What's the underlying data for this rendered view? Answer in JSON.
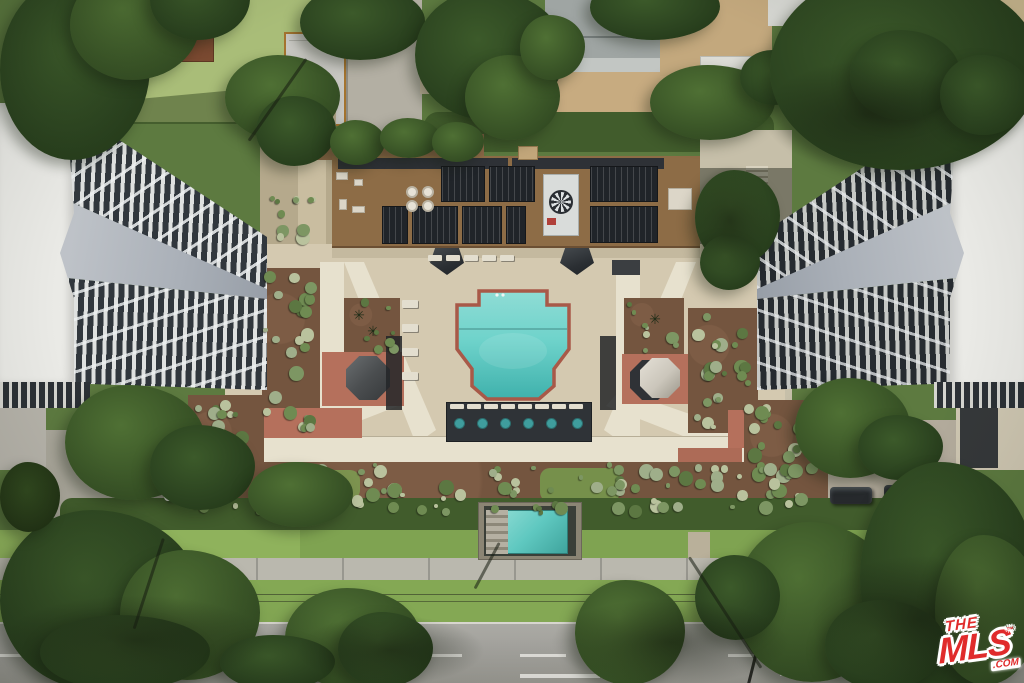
{
  "watermark": {
    "the": "THE",
    "mls": "MLS",
    "tm": "™",
    "com": ".COM"
  },
  "palette": {
    "base": "#5d7a40",
    "pool": "#6fd3cb",
    "pool_deep": "#3fb1ac",
    "pool_border": "#a85948",
    "deck": "#d4c9b0",
    "walk": "#e7e1ce",
    "roof": "#8d6c46",
    "panel": "#202429",
    "white_roof": "#ebebe7",
    "ramp": "#aab0b8",
    "bal_light": "#dfe1e0",
    "bal_dark": "#31373d",
    "balr_light": "#c6c8c5",
    "balr_dark": "#262b30",
    "mulch": "#74553f",
    "mulch2": "#6e513c",
    "red_pavers": "#b5705c",
    "red_curb": "#b43d30",
    "lawn": "#84a854",
    "lawn2": "#7fa351",
    "lawn_top": "#a9bd78",
    "hedge": "#415c2c",
    "street": "#a2a19c",
    "sidewalk": "#bab8ae",
    "sand": "#c7ab80",
    "garage": "#c9c8c3",
    "trim": "#a5742f",
    "spa": "#5fc8c0",
    "logo_red": "#e02b2b",
    "drive": "#aaa79b",
    "charcoal": "#2f3337",
    "octa_dark": "#4b4e50",
    "octa_light": "#cbc6bb"
  },
  "scene": {
    "kind": "aerial-photo",
    "elements": [
      "neighborhood-top",
      "left-tower",
      "right-tower",
      "central-rooftop-solar",
      "cross-shaped-pool",
      "pool-deck",
      "garden-beds",
      "red-paver-plazas",
      "umbrella-octagons",
      "pergola-with-spa-tables",
      "sunken-spa-court",
      "hedge-row",
      "sidewalk",
      "street",
      "parked-cars",
      "street-trees",
      "mls-watermark"
    ]
  }
}
